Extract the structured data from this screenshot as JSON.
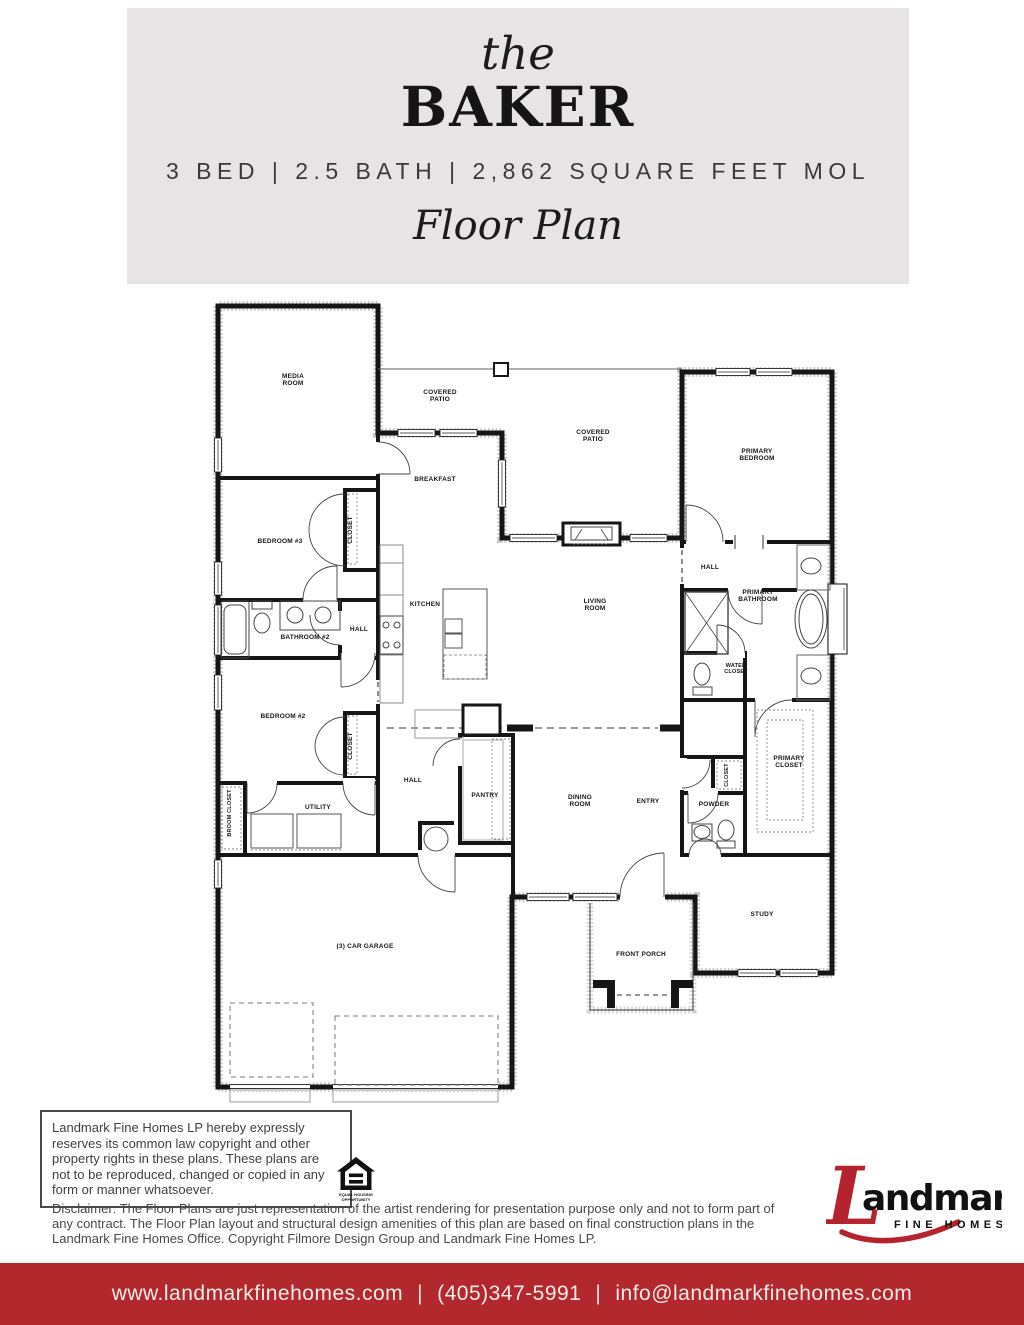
{
  "colors": {
    "header_bg": "#e6e4e5",
    "footer_bg": "#b2282c",
    "logo_red": "#b5242c",
    "wall": "#161616"
  },
  "header": {
    "prefix": "the",
    "name": "BAKER",
    "specs": "3 BED | 2.5 BATH | 2,862 SQUARE FEET MOL",
    "subtitle": "Floor Plan"
  },
  "plan": {
    "rooms": [
      {
        "id": "media-room",
        "lines": [
          "MEDIA",
          "ROOM"
        ]
      },
      {
        "id": "covered-patio-rear",
        "lines": [
          "COVERED",
          "PATIO"
        ]
      },
      {
        "id": "covered-patio-side",
        "lines": [
          "COVERED",
          "PATIO"
        ]
      },
      {
        "id": "primary-bedroom",
        "lines": [
          "PRIMARY",
          "BEDROOM"
        ]
      },
      {
        "id": "breakfast",
        "lines": [
          "BREAKFAST"
        ]
      },
      {
        "id": "bedroom-3",
        "lines": [
          "BEDROOM #3"
        ]
      },
      {
        "id": "closet-bedroom-3",
        "lines": [
          "CLOSET"
        ]
      },
      {
        "id": "hall-primary",
        "lines": [
          "HALL"
        ]
      },
      {
        "id": "kitchen",
        "lines": [
          "KITCHEN"
        ]
      },
      {
        "id": "living-room",
        "lines": [
          "LIVING",
          "ROOM"
        ]
      },
      {
        "id": "hall-bedrooms",
        "lines": [
          "HALL"
        ]
      },
      {
        "id": "bathroom-2",
        "lines": [
          "BATHROOM #2"
        ]
      },
      {
        "id": "primary-bathroom",
        "lines": [
          "PRIMARY",
          "BATHROOM"
        ]
      },
      {
        "id": "water-closet",
        "lines": [
          "WATER",
          "CLOSET"
        ]
      },
      {
        "id": "bedroom-2",
        "lines": [
          "BEDROOM #2"
        ]
      },
      {
        "id": "closet-bedroom-2",
        "lines": [
          "CLOSET"
        ]
      },
      {
        "id": "primary-closet",
        "lines": [
          "PRIMARY",
          "CLOSET"
        ]
      },
      {
        "id": "hall-center",
        "lines": [
          "HALL"
        ]
      },
      {
        "id": "pantry",
        "lines": [
          "PANTRY"
        ]
      },
      {
        "id": "dining-room",
        "lines": [
          "DINING",
          "ROOM"
        ]
      },
      {
        "id": "entry",
        "lines": [
          "ENTRY"
        ]
      },
      {
        "id": "closet-entry",
        "lines": [
          "CLOSET"
        ]
      },
      {
        "id": "powder",
        "lines": [
          "POWDER"
        ]
      },
      {
        "id": "broom-closet",
        "lines": [
          "BROOM CLOSET"
        ]
      },
      {
        "id": "utility",
        "lines": [
          "UTILITY"
        ]
      },
      {
        "id": "garage",
        "lines": [
          "(3) CAR GARAGE"
        ]
      },
      {
        "id": "front-porch",
        "lines": [
          "FRONT PORCH"
        ]
      },
      {
        "id": "study",
        "lines": [
          "STUDY"
        ]
      }
    ]
  },
  "copyright": {
    "text": "Landmark Fine Homes LP hereby expressly reserves its common law copyright and other property rights in these plans. These plans are not to be reproduced, changed or copied in any form or manner whatsoever."
  },
  "equal_housing": {
    "line1": "EQUAL HOUSING",
    "line2": "OPPORTUNITY"
  },
  "disclaimer": {
    "text": "Disclaimer: The Floor Plans are just representation of the artist rendering for presentation purpose only and not to form part of any contract. The Floor Plan layout and structural design amenities of this plan are based on final construction plans in the Landmark Fine Homes Office. Copyright Filmore Design Group and Landmark Fine Homes LP."
  },
  "logo": {
    "initial": "L",
    "rest": "andmark",
    "tagline": "FINE HOMES"
  },
  "footer": {
    "website": "www.landmarkfinehomes.com",
    "separator": "|",
    "phone": "(405)347-5991",
    "email": "info@landmarkfinehomes.com"
  }
}
